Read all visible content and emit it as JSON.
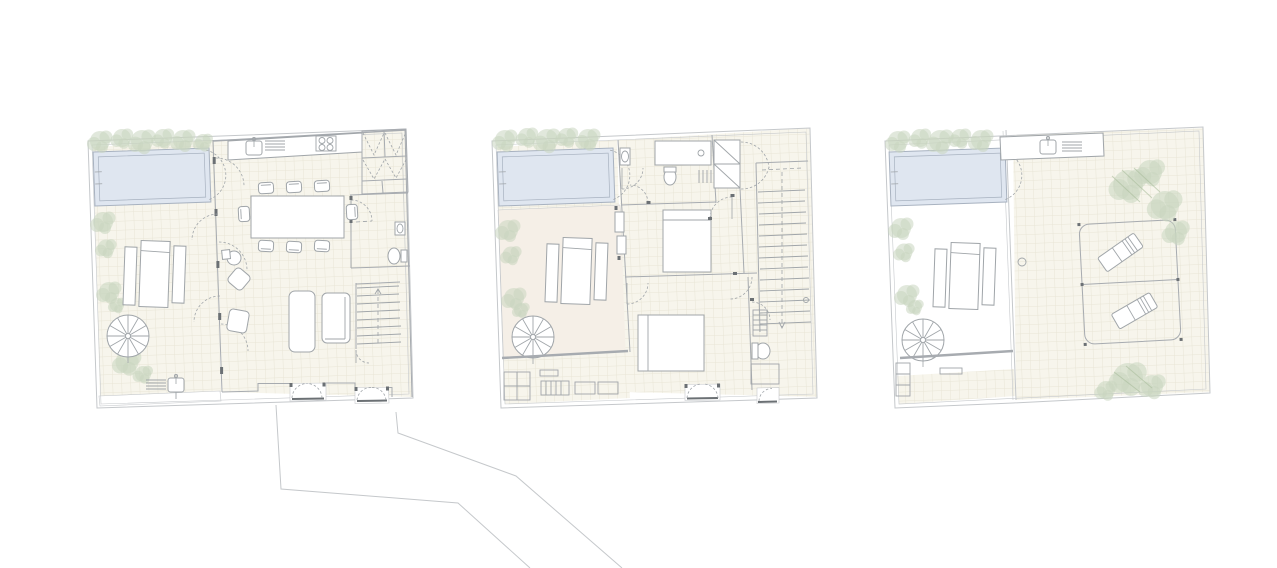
{
  "sheet": {
    "background": "#ffffff",
    "drawing_type": "architectural-floor-plan-set",
    "plan_count": 3,
    "visible_text": ""
  },
  "colors": {
    "site_line": "#c5c8cb",
    "wall_line": "#a7abb0",
    "dark_accent": "#6b7074",
    "furniture_line": "#a0a5a9",
    "floor_fill": "#f7f5ec",
    "tile_grid": "#e8e5d6",
    "terrace_fill": "#f5efe7",
    "pool_fill": "#dfe6f0",
    "pool_line": "#a8b2c0",
    "tree_fill": "#c9d5c0",
    "tree_hatch": "#a9bd9b",
    "white": "#ffffff"
  },
  "plans": [
    {
      "id": "ground-floor-plan",
      "position": "left",
      "features": [
        "swimming-pool",
        "pool-ladder",
        "tree-planting-row",
        "tiled-garden-court",
        "sun-lounger-trio",
        "spiral-staircase",
        "outdoor-shower",
        "glazed-sliding-wall-with-door-swings",
        "kitchen-counter",
        "kitchen-sink",
        "cooktop-4-burners",
        "wardrobe-closets",
        "dining-table-with-8-chairs",
        "round-side-table",
        "armchairs",
        "sofa",
        "daybed",
        "bathroom-washbasin",
        "bathroom-wc",
        "straight-staircase",
        "recessed-double-entrance-doors"
      ]
    },
    {
      "id": "first-floor-plan",
      "position": "center",
      "features": [
        "swimming-pool",
        "pool-ladder",
        "tree-planting-row",
        "terrace-deck",
        "sun-lounger-trio",
        "spiral-staircase",
        "skylight-strip",
        "planter-grid",
        "shower-room-shower-tray",
        "shower-room-wc",
        "washbasin",
        "towel-rack",
        "bifold-wardrobe",
        "straight-staircase",
        "bedroom-bed-1",
        "bedroom-bed-2",
        "towel-radiator",
        "bathroom-wc",
        "shower-enclosure",
        "recessed-window-doors",
        "divider-windows"
      ]
    },
    {
      "id": "roof-plan",
      "position": "right",
      "features": [
        "swimming-pool",
        "pool-ladder",
        "tree-planting-row",
        "sun-lounger-trio",
        "spiral-staircase",
        "stair-steps",
        "pergola-grid-strip",
        "outdoor-kitchen-counter",
        "outdoor-sink",
        "grill-vent",
        "roof-terrace-tiling",
        "deck-railing-frame",
        "deck-sun-loungers",
        "roof-trees",
        "roof-drain",
        "parapet-double-line"
      ]
    }
  ],
  "site_context": {
    "boundary_polylines": 2,
    "description_of_marks": "two thin site/street boundary lines running from below the left plan toward the bottom edge"
  }
}
